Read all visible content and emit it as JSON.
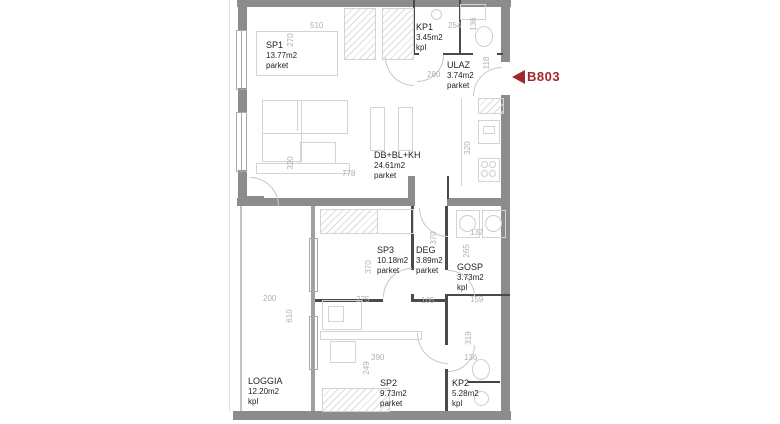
{
  "unit": {
    "label": "B803",
    "marker_color": "#a1272c"
  },
  "colors": {
    "wall": "#8c8c8c",
    "interior_wall": "#4a4a4a",
    "furniture_line": "#d4d2d2",
    "dimension_text": "#b2b0b0"
  },
  "rooms": [
    {
      "name": "SP1",
      "area": "13.77m2",
      "floor": "parket"
    },
    {
      "name": "KP1",
      "area": "3.45m2",
      "floor": "kpl"
    },
    {
      "name": "ULAZ",
      "area": "3.74m2",
      "floor": "parket"
    },
    {
      "name": "DB+BL+KH",
      "area": "24.61m2",
      "floor": "parket"
    },
    {
      "name": "SP3",
      "area": "10.18m2",
      "floor": "parket"
    },
    {
      "name": "DEG",
      "area": "3.89m2",
      "floor": "parket"
    },
    {
      "name": "GOSP",
      "area": "3.73m2",
      "floor": "kpl"
    },
    {
      "name": "LOGGIA",
      "area": "12.20m2",
      "floor": "kpl"
    },
    {
      "name": "SP2",
      "area": "9.73m2",
      "floor": "parket"
    },
    {
      "name": "KP2",
      "area": "5.28m2",
      "floor": "kpl"
    }
  ],
  "dims": [
    {
      "text": "510"
    },
    {
      "text": "270"
    },
    {
      "text": "254"
    },
    {
      "text": "136"
    },
    {
      "text": "280"
    },
    {
      "text": "118"
    },
    {
      "text": "320"
    },
    {
      "text": "778"
    },
    {
      "text": "320"
    },
    {
      "text": "200"
    },
    {
      "text": "610"
    },
    {
      "text": "275"
    },
    {
      "text": "105"
    },
    {
      "text": "370"
    },
    {
      "text": "370"
    },
    {
      "text": "137"
    },
    {
      "text": "265"
    },
    {
      "text": "159"
    },
    {
      "text": "390"
    },
    {
      "text": "249"
    },
    {
      "text": "319"
    },
    {
      "text": "136"
    }
  ]
}
